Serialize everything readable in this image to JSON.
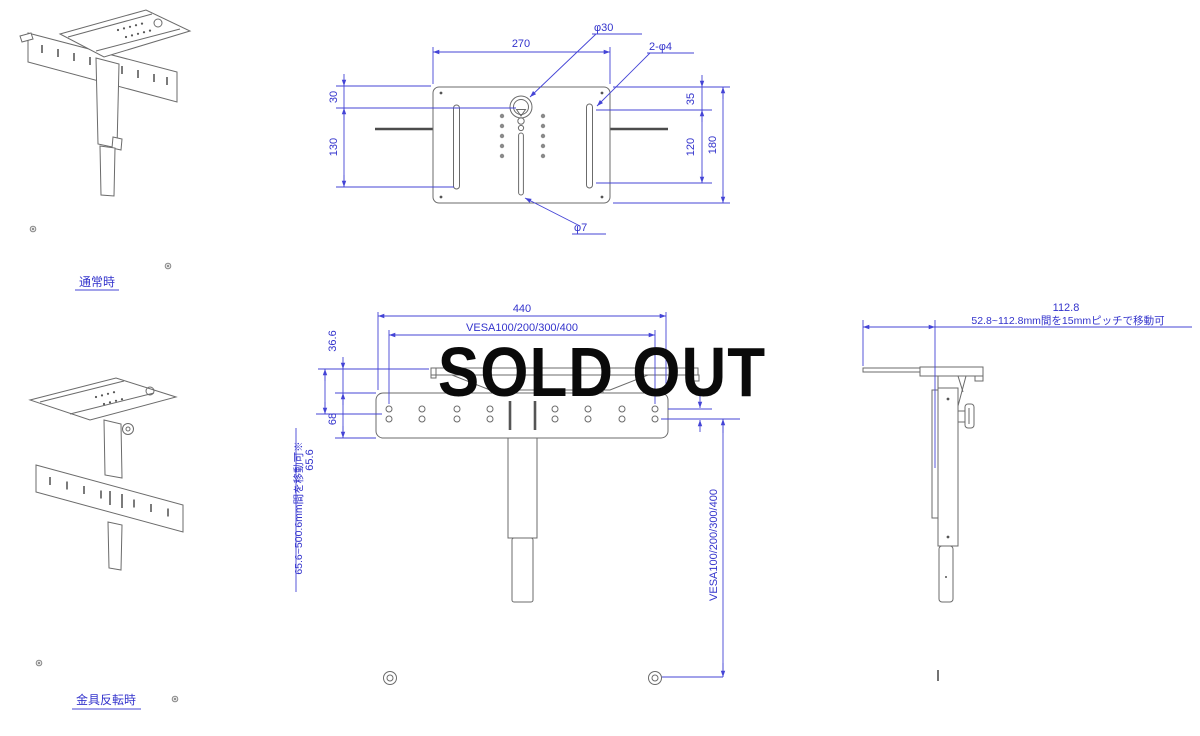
{
  "overlay": {
    "sold_out": "SOLD OUT"
  },
  "colors": {
    "drawing_line": "#6b6b6b",
    "dimension_blue": "#3333cc",
    "sold_out_text": "#0a0a0a",
    "background": "#ffffff"
  },
  "views": {
    "iso_normal": {
      "caption": "通常時"
    },
    "iso_reversed": {
      "caption": "金具反転時"
    },
    "top": {
      "dim_width": "270",
      "dim_left_upper": "30",
      "dim_left_lower": "130",
      "dim_right_upper": "35",
      "dim_right_lower": "120",
      "dim_right_total": "180",
      "label_center_hole": "φ30",
      "label_side_holes": "2-φ4",
      "label_slot": "φ7"
    },
    "front": {
      "dim_width": "440",
      "dim_vesa_horizontal": "VESA100/200/300/400",
      "dim_plate_offset": "36.6",
      "dim_bar_height": "68",
      "dim_min_drop": "65.6",
      "note_drop_range": "65.6~500.6mm間を移動可※",
      "dim_vesa_vertical": "VESA100/200/300/400"
    },
    "side": {
      "dim_depth": "112.8",
      "note_depth_range": "52.8~112.8mm間を15mmピッチで移動可"
    }
  }
}
